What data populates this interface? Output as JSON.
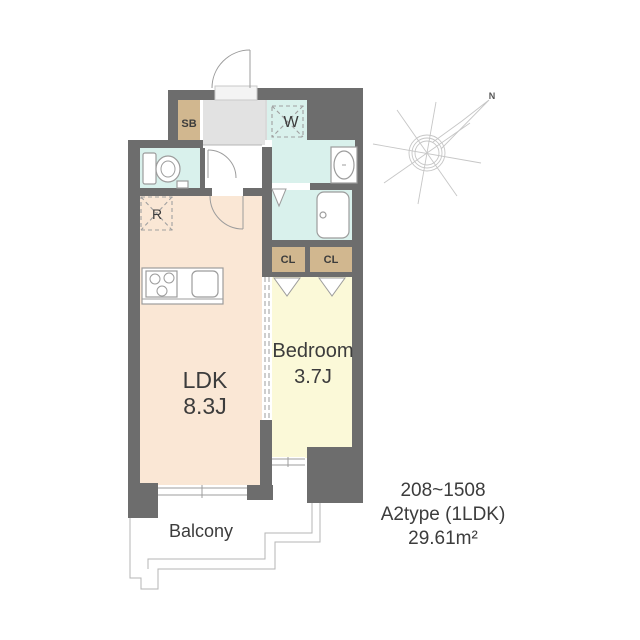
{
  "labels": {
    "shoe_box": "SB",
    "washer": "W",
    "refrigerator": "R",
    "closet": "CL",
    "ldk": "LDK",
    "ldk_size": "8.3J",
    "bedroom": "Bedroom",
    "bedroom_size": "3.7J",
    "balcony": "Balcony",
    "north": "N"
  },
  "info": {
    "floors": "208~1508",
    "type": "A2type (1LDK)",
    "area": "29.61m²"
  },
  "colors": {
    "wall": "#6d6d6d",
    "ldk": "#fae7d5",
    "bedroom": "#fbf9d8",
    "wet_area": "#d9f1ec",
    "genkan": "#e2e2e2",
    "closet_tan": "#d1b78f",
    "threshold": "#f4f4f4",
    "text": "#3c3c3c"
  }
}
